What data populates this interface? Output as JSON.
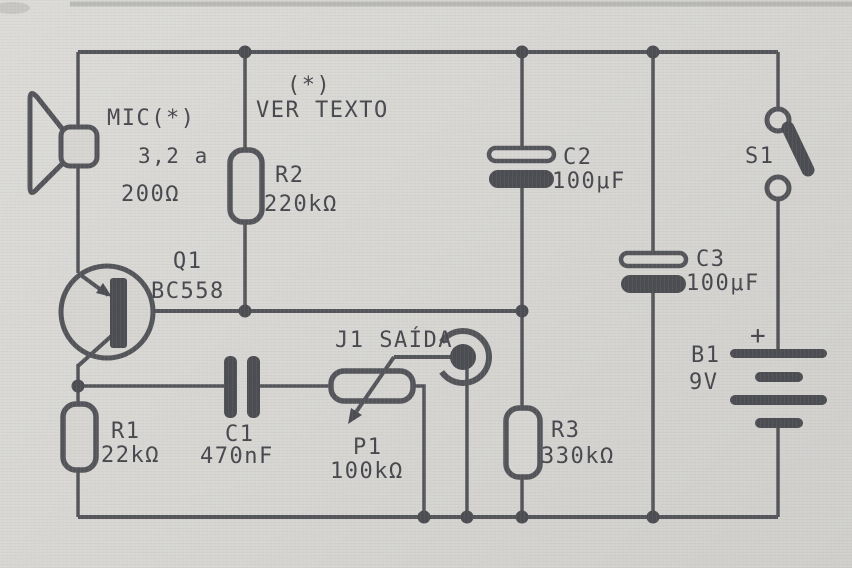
{
  "figure": {
    "kind": "scanned circuit schematic"
  },
  "annotations": {
    "asterisk_note": "(*)",
    "see_text": "VER TEXTO"
  },
  "components": {
    "mic": {
      "ref": "MIC(*)",
      "range_from": "3,2 a",
      "range_to": "200Ω"
    },
    "r1": {
      "ref": "R1",
      "value": "22kΩ"
    },
    "r2": {
      "ref": "R2",
      "value": "220kΩ"
    },
    "r3": {
      "ref": "R3",
      "value": "330kΩ"
    },
    "c1": {
      "ref": "C1",
      "value": "470nF"
    },
    "c2": {
      "ref": "C2",
      "value": "100μF"
    },
    "c3": {
      "ref": "C3",
      "value": "100μF"
    },
    "p1": {
      "ref": "P1",
      "value": "100kΩ"
    },
    "q1": {
      "ref": "Q1",
      "value": "BC558"
    },
    "s1": {
      "ref": "S1"
    },
    "b1": {
      "ref": "B1",
      "value": "9V",
      "polarity": "+"
    },
    "j1": {
      "ref": "J1 SAÍDA"
    }
  }
}
